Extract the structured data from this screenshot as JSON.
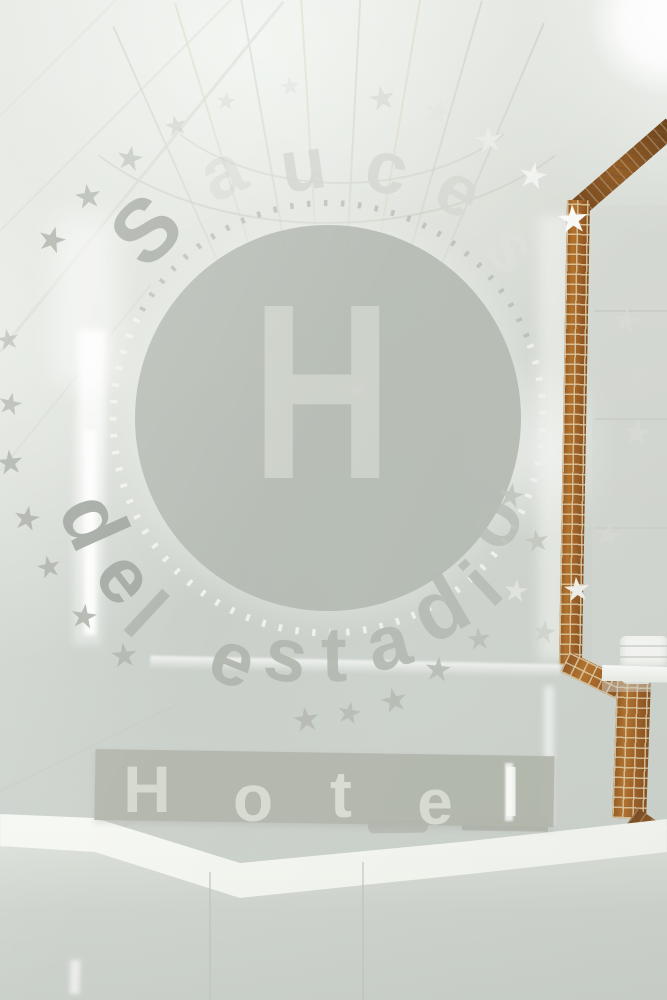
{
  "colors": {
    "disc_fill": "rgba(177,183,175,0.92)",
    "disc_letter": "rgba(203,208,200,0.95)",
    "ring_dots_top": "rgba(176,181,173,0.8)",
    "ring_dots_bottom": "rgba(241,243,238,0.95)",
    "banner_bg": "rgba(174,179,168,0.94)",
    "banner_letter": "#d6dad0",
    "mosaic_amber": "#a96a1e",
    "mosaic_dark": "#7c430f",
    "mosaic_grout": "#d8c4a0",
    "tile_white": "#eef0ea",
    "counter_white": "#f2f4ef",
    "star_white": "#fafbf9",
    "star_grey": "#aeb3ab",
    "etch_grey": "#a6aca3",
    "etch_light": "#d2d6cf"
  },
  "logo": {
    "arc_top_text": "Sauces",
    "arc_bottom_text": "del estadio",
    "center_letter": "H",
    "banner_text": "Hotel",
    "star_glyph": "★",
    "arc_top_letters": [
      {
        "ch": "S",
        "x": 146,
        "y": 230,
        "size": 88,
        "rot": -44,
        "color": "#a6aca3",
        "op": 0.95
      },
      {
        "ch": "a",
        "x": 222,
        "y": 172,
        "size": 74,
        "rot": -25,
        "color": "#c0c5bd",
        "op": 0.3
      },
      {
        "ch": "u",
        "x": 303,
        "y": 165,
        "size": 74,
        "rot": -8,
        "color": "#cfd3cc",
        "op": 0.9
      },
      {
        "ch": "c",
        "x": 387,
        "y": 168,
        "size": 74,
        "rot": 13,
        "color": "#d2d6cf",
        "op": 0.95
      },
      {
        "ch": "e",
        "x": 459,
        "y": 191,
        "size": 72,
        "rot": 30,
        "color": "#d4d8d1",
        "op": 0.95
      },
      {
        "ch": "s",
        "x": 512,
        "y": 248,
        "size": 70,
        "rot": 47,
        "color": "#e0e3dd",
        "op": 0.5
      }
    ],
    "arc_bottom_letters": [
      {
        "ch": "d",
        "x": 94,
        "y": 521,
        "size": 84,
        "rot": 66,
        "color": "#9ba19a",
        "op": 0.95
      },
      {
        "ch": "e",
        "x": 126,
        "y": 577,
        "size": 78,
        "rot": 52,
        "color": "#9da39c",
        "op": 0.95
      },
      {
        "ch": "l",
        "x": 146,
        "y": 614,
        "size": 78,
        "rot": 43,
        "color": "#a2a8a0",
        "op": 0.7
      },
      {
        "ch": "e",
        "x": 233,
        "y": 660,
        "size": 76,
        "rot": 22,
        "color": "#abb1a9",
        "op": 0.92
      },
      {
        "ch": "s",
        "x": 286,
        "y": 656,
        "size": 76,
        "rot": 10,
        "color": "#adb3ab",
        "op": 0.92
      },
      {
        "ch": "t",
        "x": 334,
        "y": 654,
        "size": 78,
        "rot": -1,
        "color": "#afb5ad",
        "op": 0.92
      },
      {
        "ch": "a",
        "x": 388,
        "y": 643,
        "size": 76,
        "rot": -15,
        "color": "#b0b6ae",
        "op": 0.92
      },
      {
        "ch": "d",
        "x": 439,
        "y": 608,
        "size": 84,
        "rot": -30,
        "color": "#b2b8b0",
        "op": 0.9
      },
      {
        "ch": "i",
        "x": 482,
        "y": 584,
        "size": 76,
        "rot": -43,
        "color": "#b4bab2",
        "op": 0.9
      },
      {
        "ch": "o",
        "x": 492,
        "y": 521,
        "size": 78,
        "rot": -58,
        "color": "#b6bcb4",
        "op": 0.85
      }
    ],
    "banner_letters": [
      {
        "ch": "H",
        "x": 147,
        "y": 789,
        "size": 66,
        "rot": 0,
        "color": "#d3d7cd",
        "op": 1
      },
      {
        "ch": "o",
        "x": 253,
        "y": 798,
        "size": 66,
        "rot": 0,
        "color": "#d6dad0",
        "op": 1
      },
      {
        "ch": "t",
        "x": 341,
        "y": 794,
        "size": 66,
        "rot": 0,
        "color": "#d8dcd2",
        "op": 1
      },
      {
        "ch": "e",
        "x": 435,
        "y": 802,
        "size": 64,
        "rot": 0,
        "color": "#d6dad0",
        "op": 1
      },
      {
        "ch": "l",
        "x": 511,
        "y": 793,
        "size": 68,
        "rot": 0,
        "color": "#eef0eb",
        "op": 1
      }
    ],
    "stars": [
      {
        "x": 8,
        "y": 340,
        "s": 22,
        "rot": -10,
        "c": "#b2b7af",
        "op": 0.8
      },
      {
        "x": 10,
        "y": 405,
        "s": 24,
        "rot": 12,
        "c": "#aeb3ab",
        "op": 0.9
      },
      {
        "x": 10,
        "y": 462,
        "s": 26,
        "rot": -6,
        "c": "#a9aea6",
        "op": 0.95
      },
      {
        "x": 27,
        "y": 518,
        "s": 26,
        "rot": 10,
        "c": "#a7aca4",
        "op": 0.95
      },
      {
        "x": 49,
        "y": 568,
        "s": 24,
        "rot": -12,
        "c": "#a9aea6",
        "op": 0.95
      },
      {
        "x": 84,
        "y": 616,
        "s": 26,
        "rot": 8,
        "c": "#abb0a8",
        "op": 0.95
      },
      {
        "x": 124,
        "y": 655,
        "s": 26,
        "rot": -5,
        "c": "#aeb3ab",
        "op": 0.95
      },
      {
        "x": 52,
        "y": 240,
        "s": 28,
        "rot": 15,
        "c": "#a4aaa1",
        "op": 0.9
      },
      {
        "x": 88,
        "y": 196,
        "s": 26,
        "rot": -8,
        "c": "#abb0a8",
        "op": 0.85
      },
      {
        "x": 130,
        "y": 158,
        "s": 26,
        "rot": 10,
        "c": "#b4b9b1",
        "op": 0.7
      },
      {
        "x": 176,
        "y": 126,
        "s": 22,
        "rot": -12,
        "c": "#bfc4bc",
        "op": 0.55
      },
      {
        "x": 226,
        "y": 102,
        "s": 20,
        "rot": 6,
        "c": "#c6cac3",
        "op": 0.4
      },
      {
        "x": 290,
        "y": 87,
        "s": 20,
        "rot": -8,
        "c": "#cdd1ca",
        "op": 0.35
      },
      {
        "x": 382,
        "y": 98,
        "s": 26,
        "rot": -10,
        "c": "#d4d8d1",
        "op": 0.9
      },
      {
        "x": 438,
        "y": 112,
        "s": 28,
        "rot": 14,
        "c": "#e0e3dd",
        "op": 0.95
      },
      {
        "x": 489,
        "y": 140,
        "s": 28,
        "rot": -6,
        "c": "#e9ebe6",
        "op": 0.95
      },
      {
        "x": 533,
        "y": 176,
        "s": 28,
        "rot": 10,
        "c": "#f2f3f0",
        "op": 1
      },
      {
        "x": 573,
        "y": 220,
        "s": 30,
        "rot": -4,
        "c": "#fafbf9",
        "op": 1
      },
      {
        "x": 626,
        "y": 320,
        "s": 26,
        "rot": 8,
        "c": "#d9dcd5",
        "op": 0.95
      },
      {
        "x": 637,
        "y": 376,
        "s": 28,
        "rot": -10,
        "c": "#d6d9d2",
        "op": 0.95
      },
      {
        "x": 637,
        "y": 433,
        "s": 28,
        "rot": 6,
        "c": "#d8dbd4",
        "op": 0.95
      },
      {
        "x": 627,
        "y": 487,
        "s": 26,
        "rot": -8,
        "c": "#d3d6cf",
        "op": 0.95
      },
      {
        "x": 608,
        "y": 535,
        "s": 26,
        "rot": 10,
        "c": "#d6d9d2",
        "op": 0.95
      },
      {
        "x": 577,
        "y": 589,
        "s": 26,
        "rot": -5,
        "c": "#eff0ec",
        "op": 1
      },
      {
        "x": 544,
        "y": 633,
        "s": 24,
        "rot": 8,
        "c": "#cfd3cb",
        "op": 0.9
      },
      {
        "x": 306,
        "y": 719,
        "s": 26,
        "rot": -8,
        "c": "#b3b8b0",
        "op": 0.95
      },
      {
        "x": 349,
        "y": 714,
        "s": 24,
        "rot": 10,
        "c": "#b5bab2",
        "op": 0.95
      },
      {
        "x": 394,
        "y": 700,
        "s": 26,
        "rot": -12,
        "c": "#b4b9b1",
        "op": 0.95
      },
      {
        "x": 438,
        "y": 669,
        "s": 26,
        "rot": 6,
        "c": "#b6bbb3",
        "op": 0.95
      },
      {
        "x": 479,
        "y": 640,
        "s": 24,
        "rot": -5,
        "c": "#b8bdb5",
        "op": 0.9
      },
      {
        "x": 511,
        "y": 495,
        "s": 26,
        "rot": 10,
        "c": "#bec3bb",
        "op": 0.9
      },
      {
        "x": 537,
        "y": 542,
        "s": 24,
        "rot": -8,
        "c": "#c0c5bd",
        "op": 0.9
      },
      {
        "x": 516,
        "y": 592,
        "s": 24,
        "rot": 6,
        "c": "#e4e6e1",
        "op": 0.9
      }
    ]
  }
}
